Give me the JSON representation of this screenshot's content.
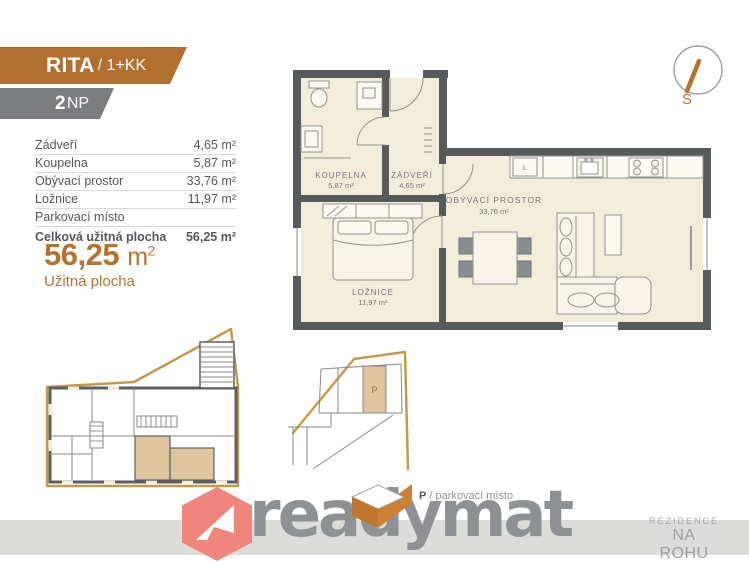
{
  "header": {
    "unit_name": "RITA",
    "unit_type": "/ 1+KK",
    "floor_number": "2",
    "floor_suffix": "NP"
  },
  "area_table": {
    "rows": [
      {
        "label": "Zádveří",
        "value": "4,65 m²"
      },
      {
        "label": "Koupelna",
        "value": "5,87 m²"
      },
      {
        "label": "Obývací prostor",
        "value": "33,76 m²"
      },
      {
        "label": "Ložnice",
        "value": "11,97 m²"
      },
      {
        "label": "Parkovací místo",
        "value": ""
      },
      {
        "label": "Celková užitná plocha",
        "value": "56,25 m²"
      }
    ]
  },
  "summary": {
    "value": "56,25",
    "unit": "m",
    "sup": "2",
    "caption": "Užitná plocha"
  },
  "floor_plan": {
    "rooms": [
      {
        "name": "KOUPELNA",
        "area": "5,87 m²"
      },
      {
        "name": "ZÁDVEŘÍ",
        "area": "4,65 m²"
      },
      {
        "name": "OBÝVACÍ PROSTOR",
        "area": "33,76 m²"
      },
      {
        "name": "LOŽNICE",
        "area": "11,97 m²"
      }
    ],
    "kitchen_fridge_label": "L"
  },
  "compass": {
    "south_label": "S"
  },
  "parking_legend": {
    "symbol": "P",
    "text": "/ parkovací místo"
  },
  "mini_plans": {
    "parking_spot_label": "P"
  },
  "branding": {
    "logo_text": "readymat",
    "project_name_line1": "REZIDENCE",
    "project_name_line2": "NA ROHU"
  },
  "colors": {
    "accent_orange": "#b26f2e",
    "banner_gray": "#7b7d80",
    "wall_gray": "#565a5b",
    "floor_cream": "#f2ecdb",
    "site_gold": "#c49a4a",
    "highlight_tan": "#dfc49c",
    "logo_salmon": "#f0867b",
    "logo_text_gray": "#8d9193"
  }
}
